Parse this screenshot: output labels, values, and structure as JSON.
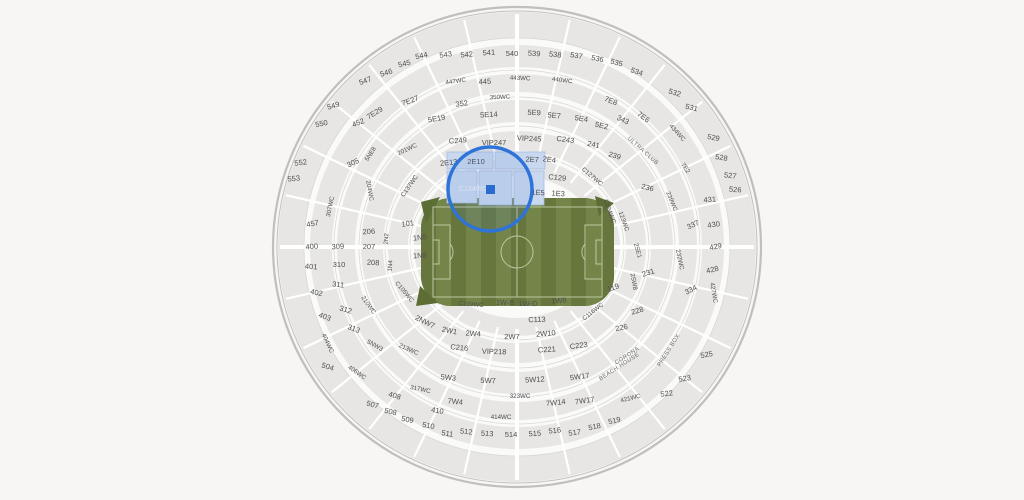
{
  "title": "Stadium seating map",
  "selection": {
    "section": "C134WC"
  },
  "colors": {
    "background": "#f7f6f4",
    "rim_fill": "#fafaf9",
    "rim_stroke": "#c0bfbd",
    "band_fill": "#e8e6e4",
    "band_arc": "#d6d5d3",
    "spoke": "#ffffff",
    "label": "#4f4f4f",
    "field_green": "#6d7e41",
    "field_stripe_dark": "#66763c",
    "field_stripe_light": "#748549",
    "field_wedge": "#5d6d36",
    "field_line": "#bcc8a2",
    "highlight_fill": "#c9d8ee",
    "highlight_stroke": "#a6bfe3",
    "selection_ring": "#2e74d8",
    "marker": "#2b6cd0"
  },
  "sections": [
    [
      "544",
      422,
      58,
      -12
    ],
    [
      "543",
      446,
      57,
      -9
    ],
    [
      "542",
      467,
      57,
      -6
    ],
    [
      "541",
      489,
      55,
      -3
    ],
    [
      "540",
      512,
      56,
      0
    ],
    [
      "539",
      534,
      56,
      3
    ],
    [
      "538",
      555,
      57,
      6
    ],
    [
      "537",
      576,
      58,
      9
    ],
    [
      "536",
      597,
      61,
      12
    ],
    [
      "535",
      616,
      65,
      15
    ],
    [
      "534",
      636,
      74,
      19
    ],
    [
      "545",
      405,
      66,
      -14
    ],
    [
      "546",
      387,
      75,
      -17
    ],
    [
      "547",
      366,
      83,
      -20
    ],
    [
      "549",
      334,
      108,
      -16
    ],
    [
      "550",
      322,
      126,
      -12
    ],
    [
      "552",
      301,
      165,
      -8
    ],
    [
      "553",
      294,
      181,
      -6
    ],
    [
      "532",
      674,
      95,
      18
    ],
    [
      "531",
      691,
      110,
      14
    ],
    [
      "529",
      713,
      140,
      12
    ],
    [
      "528",
      721,
      160,
      9
    ],
    [
      "527",
      730,
      178,
      7
    ],
    [
      "526",
      735,
      192,
      5
    ],
    [
      "525",
      707,
      357,
      -10
    ],
    [
      "523",
      685,
      381,
      -9
    ],
    [
      "522",
      667,
      396,
      -8
    ],
    [
      "519",
      615,
      423,
      -13
    ],
    [
      "518",
      595,
      429,
      -11
    ],
    [
      "517",
      575,
      435,
      -8
    ],
    [
      "516",
      555,
      433,
      -6
    ],
    [
      "515",
      535,
      436,
      -4
    ],
    [
      "514",
      511,
      437,
      0
    ],
    [
      "513",
      487,
      436,
      4
    ],
    [
      "512",
      466,
      434,
      6
    ],
    [
      "511",
      447,
      436,
      8
    ],
    [
      "510",
      428,
      428,
      10
    ],
    [
      "509",
      407,
      422,
      11
    ],
    [
      "508",
      390,
      414,
      13
    ],
    [
      "507",
      372,
      407,
      15
    ],
    [
      "504",
      327,
      369,
      18
    ],
    [
      "447WC",
      456,
      83,
      -8,
      "sm"
    ],
    [
      "445",
      485,
      84,
      -3
    ],
    [
      "443WC",
      520,
      80,
      2,
      "sm"
    ],
    [
      "440WC",
      562,
      82,
      7,
      "sm"
    ],
    [
      "434WC",
      676,
      134,
      48,
      "sm"
    ],
    [
      "452",
      359,
      125,
      -22
    ],
    [
      "457",
      313,
      226,
      -10
    ],
    [
      "400",
      312,
      249,
      -5
    ],
    [
      "401",
      311,
      269,
      5
    ],
    [
      "402",
      316,
      295,
      12
    ],
    [
      "403",
      324,
      319,
      20
    ],
    [
      "404WC",
      326,
      344,
      65,
      "sm"
    ],
    [
      "406WC",
      356,
      374,
      35,
      "sm"
    ],
    [
      "408",
      394,
      398,
      16
    ],
    [
      "410",
      437,
      413,
      9
    ],
    [
      "414WC",
      501,
      419,
      0,
      "sm"
    ],
    [
      "421WC",
      631,
      400,
      -14,
      "sm"
    ],
    [
      "427WC",
      712,
      293,
      80,
      "sm"
    ],
    [
      "428",
      713,
      272,
      -14
    ],
    [
      "429",
      716,
      249,
      -10
    ],
    [
      "430",
      714,
      227,
      -8
    ],
    [
      "431",
      710,
      202,
      -5
    ],
    [
      "350WC",
      500,
      99,
      -2,
      "sm"
    ],
    [
      "352",
      462,
      106,
      -8
    ],
    [
      "343",
      622,
      122,
      25
    ],
    [
      "305",
      354,
      165,
      -25
    ],
    [
      "307WC",
      332,
      207,
      -78,
      "sm"
    ],
    [
      "309",
      338,
      249,
      -4
    ],
    [
      "310",
      339,
      267,
      0
    ],
    [
      "311",
      338,
      287,
      6
    ],
    [
      "312",
      345,
      312,
      16
    ],
    [
      "313",
      353,
      331,
      20
    ],
    [
      "317WC",
      420,
      391,
      12,
      "sm"
    ],
    [
      "323WC",
      520,
      398,
      0,
      "sm"
    ],
    [
      "334",
      692,
      292,
      -28
    ],
    [
      "337",
      694,
      227,
      -25
    ],
    [
      "7E29",
      376,
      115,
      -32
    ],
    [
      "7E27",
      411,
      103,
      -20
    ],
    [
      "7E8",
      610,
      103,
      22
    ],
    [
      "7E6",
      642,
      119,
      36
    ],
    [
      "7E2",
      684,
      169,
      55,
      "sm"
    ],
    [
      "7W4",
      455,
      404,
      6
    ],
    [
      "7W14",
      556,
      405,
      -6
    ],
    [
      "7W17",
      585,
      403,
      -8
    ],
    [
      "5E19",
      437,
      121,
      -10
    ],
    [
      "5E14",
      489,
      117,
      -3
    ],
    [
      "5E9",
      534,
      115,
      2
    ],
    [
      "5E7",
      554,
      118,
      5
    ],
    [
      "5E4",
      581,
      121,
      9
    ],
    [
      "5E2",
      601,
      128,
      13
    ],
    [
      "5NE8",
      372,
      155,
      -58,
      "sm"
    ],
    [
      "5NW3",
      374,
      347,
      30,
      "sm"
    ],
    [
      "5W3",
      448,
      380,
      6
    ],
    [
      "5W7",
      488,
      383,
      2
    ],
    [
      "5W12",
      535,
      382,
      -4
    ],
    [
      "5W17",
      580,
      379,
      -8
    ],
    [
      "201WC",
      408,
      151,
      -25,
      "sm"
    ],
    [
      "204WC",
      368,
      191,
      80,
      "sm"
    ],
    [
      "206",
      369,
      234,
      -4
    ],
    [
      "207",
      369,
      249,
      0
    ],
    [
      "208",
      373,
      265,
      3
    ],
    [
      "210WC",
      367,
      306,
      55,
      "sm"
    ],
    [
      "213WC",
      408,
      351,
      24,
      "sm"
    ],
    [
      "2NW7",
      424,
      324,
      26
    ],
    [
      "2N2",
      388,
      239,
      -86,
      "sm"
    ],
    [
      "2W1",
      449,
      333,
      12
    ],
    [
      "2W4",
      473,
      336,
      4
    ],
    [
      "2W7",
      512,
      339,
      0
    ],
    [
      "2W10",
      546,
      336,
      -5
    ],
    [
      "2SW8",
      632,
      282,
      80,
      "sm"
    ],
    [
      "2SE1",
      636,
      251,
      75,
      "sm"
    ],
    [
      "231",
      649,
      275,
      -18
    ],
    [
      "232WC",
      678,
      260,
      78,
      "sm"
    ],
    [
      "228",
      638,
      313,
      -16
    ],
    [
      "226",
      622,
      330,
      -12
    ],
    [
      "236",
      647,
      190,
      14
    ],
    [
      "239",
      614,
      158,
      16
    ],
    [
      "241",
      593,
      147,
      12
    ],
    [
      "C243",
      565,
      142,
      8
    ],
    [
      "VIP245",
      529,
      141,
      3
    ],
    [
      "VIP247",
      494,
      145,
      0
    ],
    [
      "C249",
      458,
      143,
      -4
    ],
    [
      "239WC",
      670,
      202,
      68,
      "sm"
    ],
    [
      "2E13",
      449,
      165,
      -6
    ],
    [
      "2E10",
      476,
      164,
      0
    ],
    [
      "2E7",
      532,
      162,
      3
    ],
    [
      "2E4",
      549,
      162,
      8
    ],
    [
      "C129",
      557,
      180,
      6
    ],
    [
      "C127WC",
      591,
      178,
      40,
      "sm"
    ],
    [
      "C124WC",
      608,
      212,
      70,
      "sm"
    ],
    [
      "123WC",
      622,
      222,
      70,
      "sm"
    ],
    [
      "C137WC",
      411,
      187,
      -55,
      "sm"
    ],
    [
      "C134WC",
      473,
      191,
      0,
      "hl"
    ],
    [
      "1E5",
      538,
      195,
      2
    ],
    [
      "1E3",
      558,
      196,
      4
    ],
    [
      "101",
      408,
      226,
      -8
    ],
    [
      "1N5",
      420,
      240,
      -5
    ],
    [
      "1N8",
      420,
      258,
      -3
    ],
    [
      "1N4",
      392,
      266,
      -86,
      "sm"
    ],
    [
      "C105WC",
      403,
      293,
      50,
      "sm"
    ],
    [
      "C109WC",
      471,
      306,
      5,
      "sm"
    ],
    [
      "1W-B",
      505,
      305,
      2
    ],
    [
      "1W-D",
      528,
      306,
      0
    ],
    [
      "1W8",
      559,
      303,
      -4
    ],
    [
      "C113",
      537,
      322,
      -2
    ],
    [
      "C116WC",
      594,
      313,
      -38,
      "sm"
    ],
    [
      "119",
      614,
      290,
      -20
    ],
    [
      "C216",
      459,
      350,
      6
    ],
    [
      "VIP218",
      494,
      354,
      2
    ],
    [
      "C221",
      547,
      352,
      -4
    ],
    [
      "C223",
      579,
      348,
      -7
    ],
    [
      "ULTRA CLUB",
      642,
      152,
      42,
      "club"
    ],
    [
      "PRESS BOX",
      670,
      351,
      -58,
      "club"
    ],
    [
      "CORONA",
      628,
      357,
      -33,
      "club"
    ],
    [
      "BEACH HOUSE",
      620,
      368,
      -33,
      "club"
    ]
  ],
  "geometry_note": "center 517,247"
}
